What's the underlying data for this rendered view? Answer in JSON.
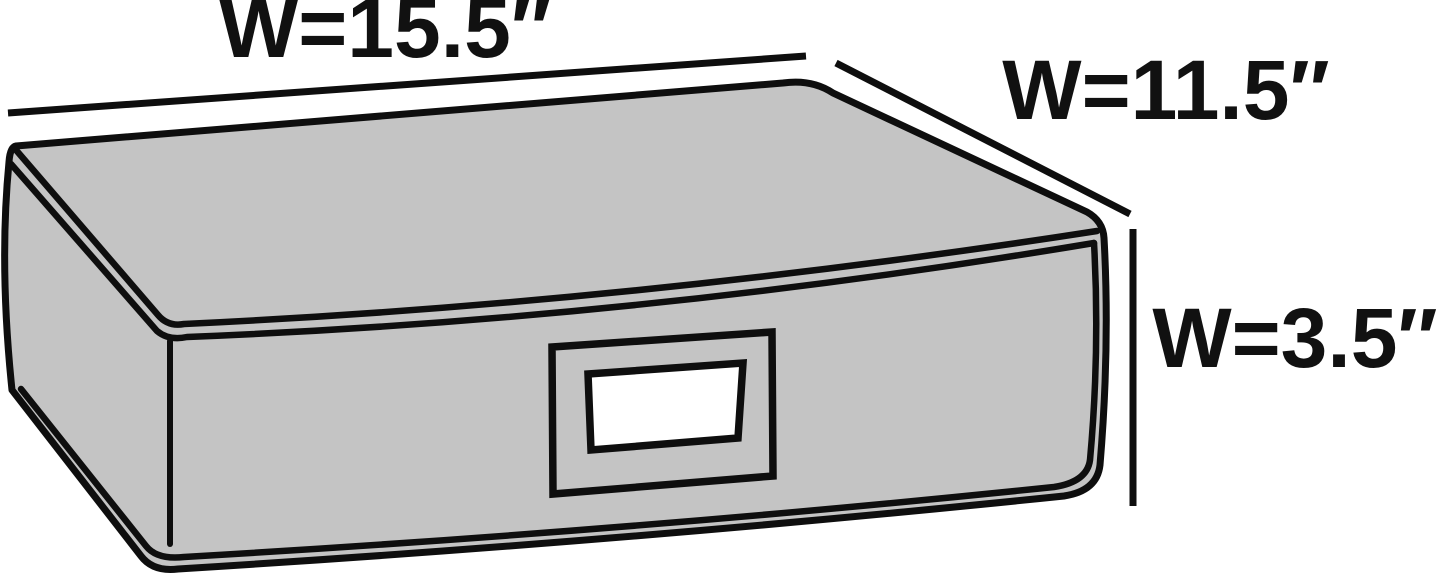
{
  "diagram": {
    "description": "Line-art product dimension diagram of a gray fabric under-bed storage box shown in three-quarter perspective with a label-holder window on the front panel and three dimension callout lines",
    "dimensions": [
      {
        "id": "top-width",
        "label": "W=15.5″",
        "position": "top-left-edge"
      },
      {
        "id": "side-width",
        "label": "W=11.5″",
        "position": "top-right-edge"
      },
      {
        "id": "height",
        "label": "W=3.5″",
        "position": "right-edge"
      }
    ],
    "colors": {
      "background": "#ffffff",
      "box_fill": "#c4c4c4",
      "line": "#0e0e0e",
      "label_window": "#ffffff",
      "text": "#111111"
    }
  }
}
